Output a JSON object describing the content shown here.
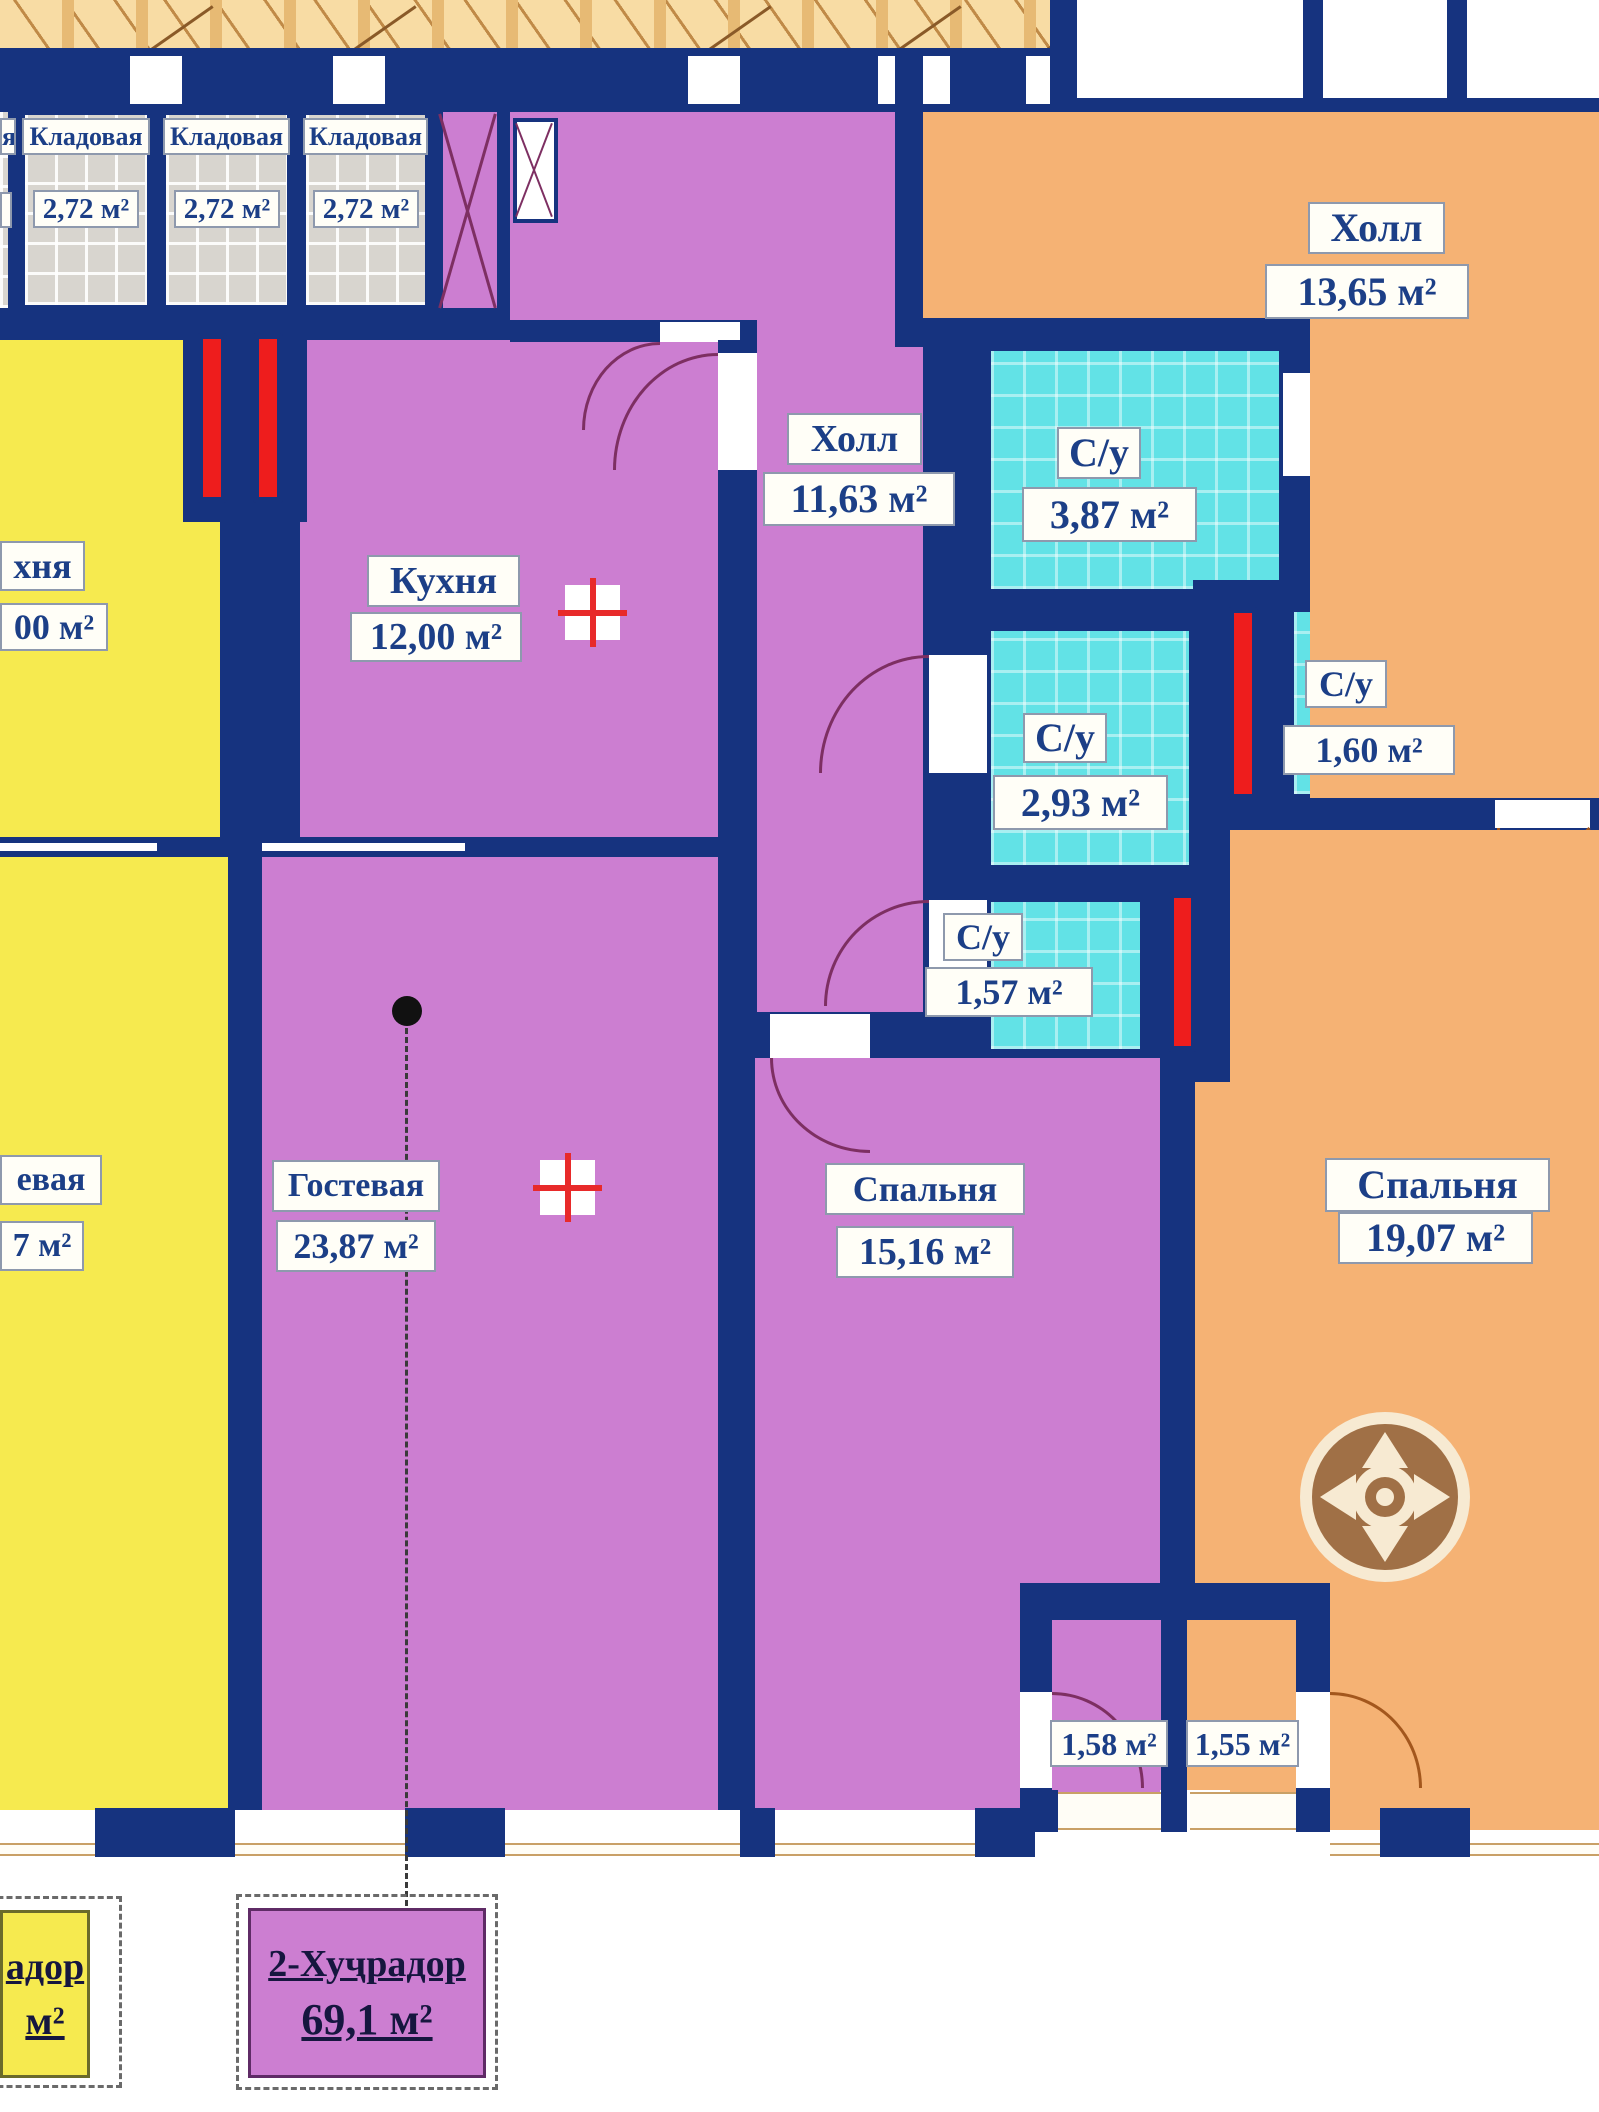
{
  "plan_title": "Apartment floor plan",
  "colors": {
    "wall": "#16337f",
    "purple_apartment": "#cc7ed1",
    "yellow_apartment": "#f6ea4f",
    "orange_apartment": "#f5b274",
    "bathroom_cyan": "#62e2e6",
    "storage_gray": "#d8d5cf",
    "vent_shaft_red": "#ee1d1d",
    "corridor_hatch": "#f8dca4",
    "label_text": "#1c3f87"
  },
  "rooms": {
    "storage1": {
      "name": "Кладовая",
      "area": "2,72 м²"
    },
    "storage2": {
      "name": "Кладовая",
      "area": "2,72 м²"
    },
    "storage3": {
      "name": "Кладовая",
      "area": "2,72 м²"
    },
    "storage_partial": {
      "name_fragment": "я"
    },
    "yellow_kitchen": {
      "name_fragment": "хня",
      "area_fragment": "00 м²"
    },
    "yellow_living": {
      "name_fragment": "евая",
      "area_fragment": "7 м²"
    },
    "kitchen": {
      "name": "Кухня",
      "area": "12,00 м²"
    },
    "hall": {
      "name": "Холл",
      "area": "11,63 м²"
    },
    "guest": {
      "name": "Гостевая",
      "area": "23,87 м²"
    },
    "bedroom_15": {
      "name": "Спальня",
      "area": "15,16 м²"
    },
    "bedroom_19": {
      "name": "Спальня",
      "area": "19,07 м²"
    },
    "orange_hall": {
      "name": "Холл",
      "area": "13,65 м²"
    },
    "wc_387": {
      "name": "С/у",
      "area": "3,87 м²"
    },
    "wc_293": {
      "name": "С/у",
      "area": "2,93 м²"
    },
    "wc_157": {
      "name": "С/у",
      "area": "1,57 м²"
    },
    "wc_160": {
      "name": "С/у",
      "area": "1,60 м²"
    },
    "balcony_158": {
      "area": "1,58 м²"
    },
    "balcony_155": {
      "area": "1,55 м²"
    }
  },
  "legend": {
    "unit2": {
      "title": "2-Хуҷрадор",
      "area": "69,1 м²"
    },
    "unit_left": {
      "title_fragment": "адор",
      "area_fragment": "м²"
    }
  }
}
